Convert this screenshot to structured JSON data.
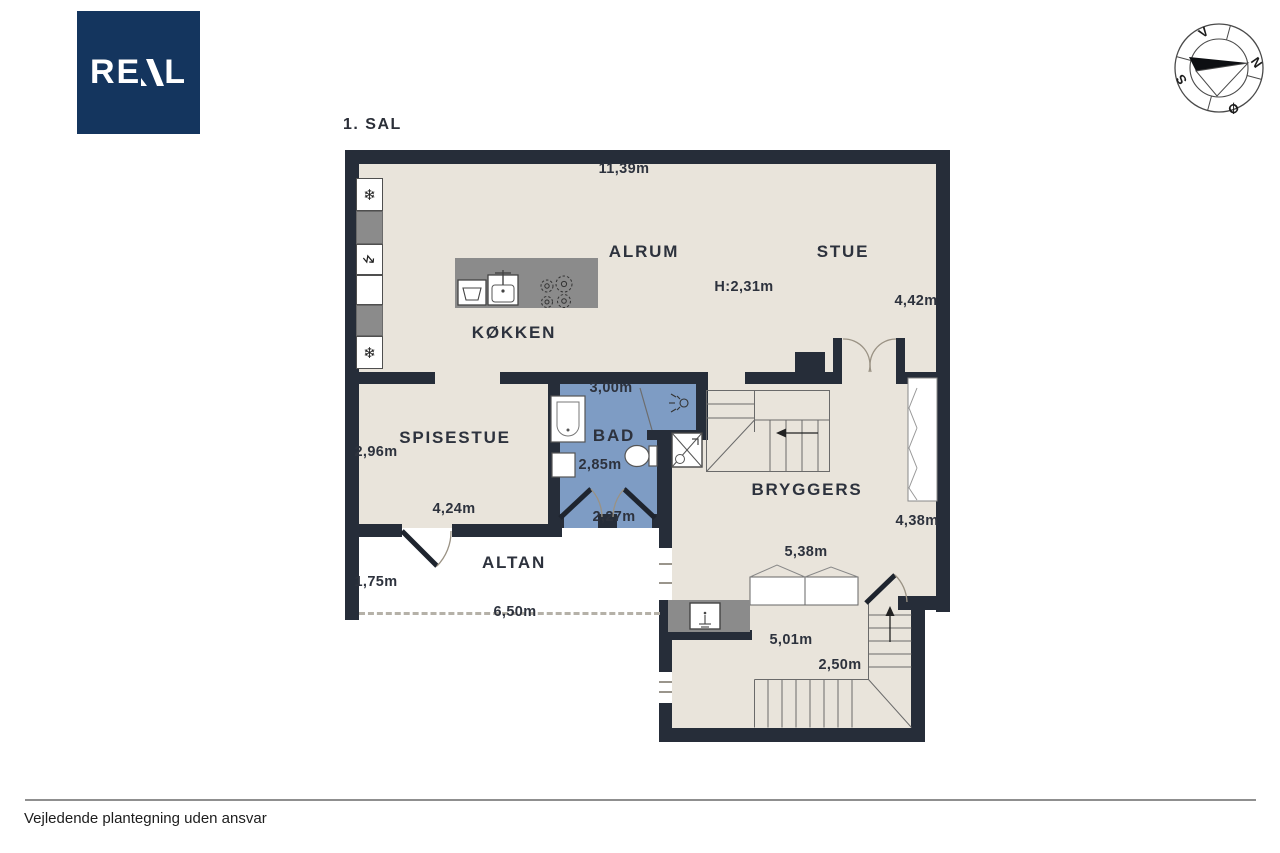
{
  "colors": {
    "wall": "#262d39",
    "floor": "#e9e4db",
    "bath": "#7e9cc4",
    "counter": "#8b8b8b",
    "logo": "#14355e",
    "text": "#2d323d"
  },
  "logo": {
    "text": "REAL",
    "part_re": "RE",
    "part_l": "L"
  },
  "plan": {
    "title": "1. SAL",
    "rooms": [
      {
        "label": "ALRUM"
      },
      {
        "label": "STUE"
      },
      {
        "label": "KØKKEN"
      },
      {
        "label": "SPISESTUE"
      },
      {
        "label": "BAD"
      },
      {
        "label": "BRYGGERS"
      },
      {
        "label": "ALTAN"
      }
    ],
    "dims": [
      {
        "id": "overall-width",
        "text": "11,39m"
      },
      {
        "id": "ceiling-height",
        "text": "H:2,31m"
      },
      {
        "id": "stue-depth",
        "text": "4,42m"
      },
      {
        "id": "spisestue-depth",
        "text": "2,96m"
      },
      {
        "id": "spisestue-width",
        "text": "4,24m"
      },
      {
        "id": "bad-width",
        "text": "3,00m"
      },
      {
        "id": "bad-depth",
        "text": "2,85m"
      },
      {
        "id": "bad-bottom",
        "text": "2,27m"
      },
      {
        "id": "bryggers-depth",
        "text": "4,38m"
      },
      {
        "id": "bryggers-width",
        "text": "5,38m"
      },
      {
        "id": "altan-depth",
        "text": "1,75m"
      },
      {
        "id": "altan-width",
        "text": "6,50m"
      },
      {
        "id": "stairroom-width",
        "text": "5,01m"
      },
      {
        "id": "stairroom-depth",
        "text": "2,50m"
      }
    ],
    "compass": {
      "n": "N",
      "s": "S",
      "e": "Ø",
      "w": "V"
    },
    "symbols": {
      "freezer": "❄",
      "power": "↯"
    }
  },
  "footer": {
    "note": "Vejledende plantegning uden ansvar"
  }
}
